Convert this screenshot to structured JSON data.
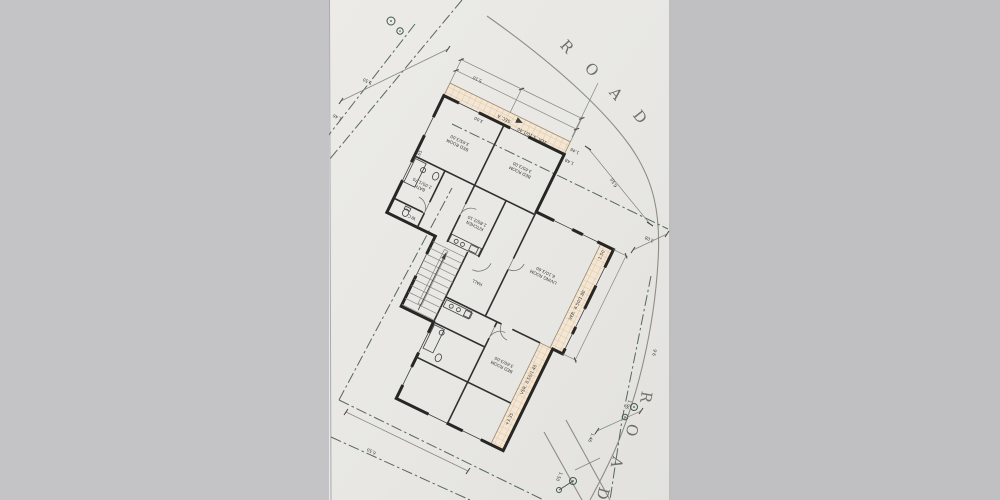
{
  "photo": {
    "background_left": "#c4c4c6",
    "background_right": "#c0c0c2",
    "paper_color": "#e9e8e4",
    "boundary_green": "#56695b",
    "hatch_fill": "#f3e6d4",
    "hatch_line": "#ddbf9e",
    "wall_color": "#262624"
  },
  "roads": {
    "top": {
      "letters": [
        "R",
        "O",
        "A",
        "D"
      ]
    },
    "right": {
      "letters": [
        "R",
        "O",
        "A",
        "D"
      ]
    }
  },
  "plan": {
    "section_label": "SEC. A",
    "level_note": "+3.35",
    "rooms": [
      {
        "name": "BED ROOM",
        "size": "3.65/3.00"
      },
      {
        "name": "BED ROOM",
        "size": "3.65/3.00"
      },
      {
        "name": "KITCHEN",
        "size": "2.80/2.10"
      },
      {
        "name": "BATH",
        "size": "2.05/1.70"
      },
      {
        "name": "W.C.",
        "size": ""
      },
      {
        "name": "HALL",
        "size": ""
      },
      {
        "name": "LIVING ROOM",
        "size": "6.10/3.60"
      },
      {
        "name": "BED ROOM",
        "size": "3.60/3.00"
      }
    ],
    "verandas": [
      {
        "label": "VER.",
        "size": "5.10/1.40"
      },
      {
        "label": "VER.",
        "size": "4.50/1.80"
      },
      {
        "label": "VER.",
        "size": "8.50/1.40"
      }
    ],
    "interior_dims": [
      "3.00",
      "3.65",
      "1.46",
      "1.48",
      "1.50"
    ]
  },
  "site_dims": {
    "top_plot": "5.50",
    "top_offset": "1.46",
    "front_width": "5.10",
    "right_setback": "6.50",
    "road_width": "3.08",
    "bottom_plot": "6.50",
    "bearing": "9.6",
    "road_marks": [
      "1.96",
      "1.46",
      "1.50"
    ]
  }
}
